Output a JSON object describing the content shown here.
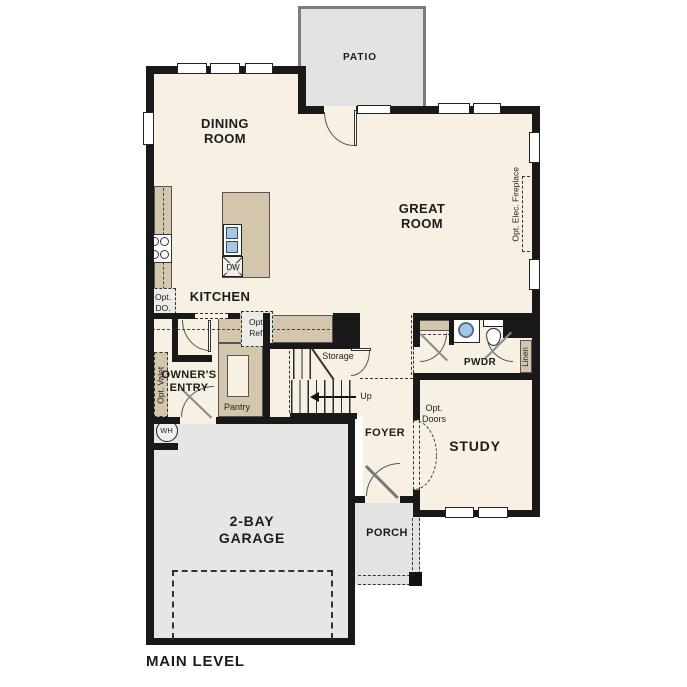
{
  "plan": {
    "title": "MAIN LEVEL",
    "rooms": {
      "patio": "PATIO",
      "dining_room": "DINING\nROOM",
      "great_room": "GREAT\nROOM",
      "kitchen": "KITCHEN",
      "owners_entry": "OWNER'S\nENTRY",
      "pantry": "Pantry",
      "storage": "Storage",
      "foyer": "FOYER",
      "powder_room": "PWDR",
      "linen": "Linen",
      "study": "STUDY",
      "garage": "2-BAY\nGARAGE",
      "porch": "PORCH"
    },
    "annotations": {
      "opt_double_oven": "Opt.\nDO.",
      "opt_refrigerator": "Opt.\nRef.",
      "opt_valet": "Opt. Valet",
      "opt_doors": "Opt.\nDoors",
      "opt_elec_fireplace": "Opt. Elec. Fireplace",
      "stairs_up": "Up",
      "water_heater": "WH",
      "dishwasher": "DW"
    },
    "colors": {
      "floor": "#f7f0e3",
      "outdoor_concrete": "#e3e3e1",
      "cabinetry": "#d3c6ad",
      "wall": "#191919",
      "plumbing_fixture": "#a6c6e6"
    }
  }
}
